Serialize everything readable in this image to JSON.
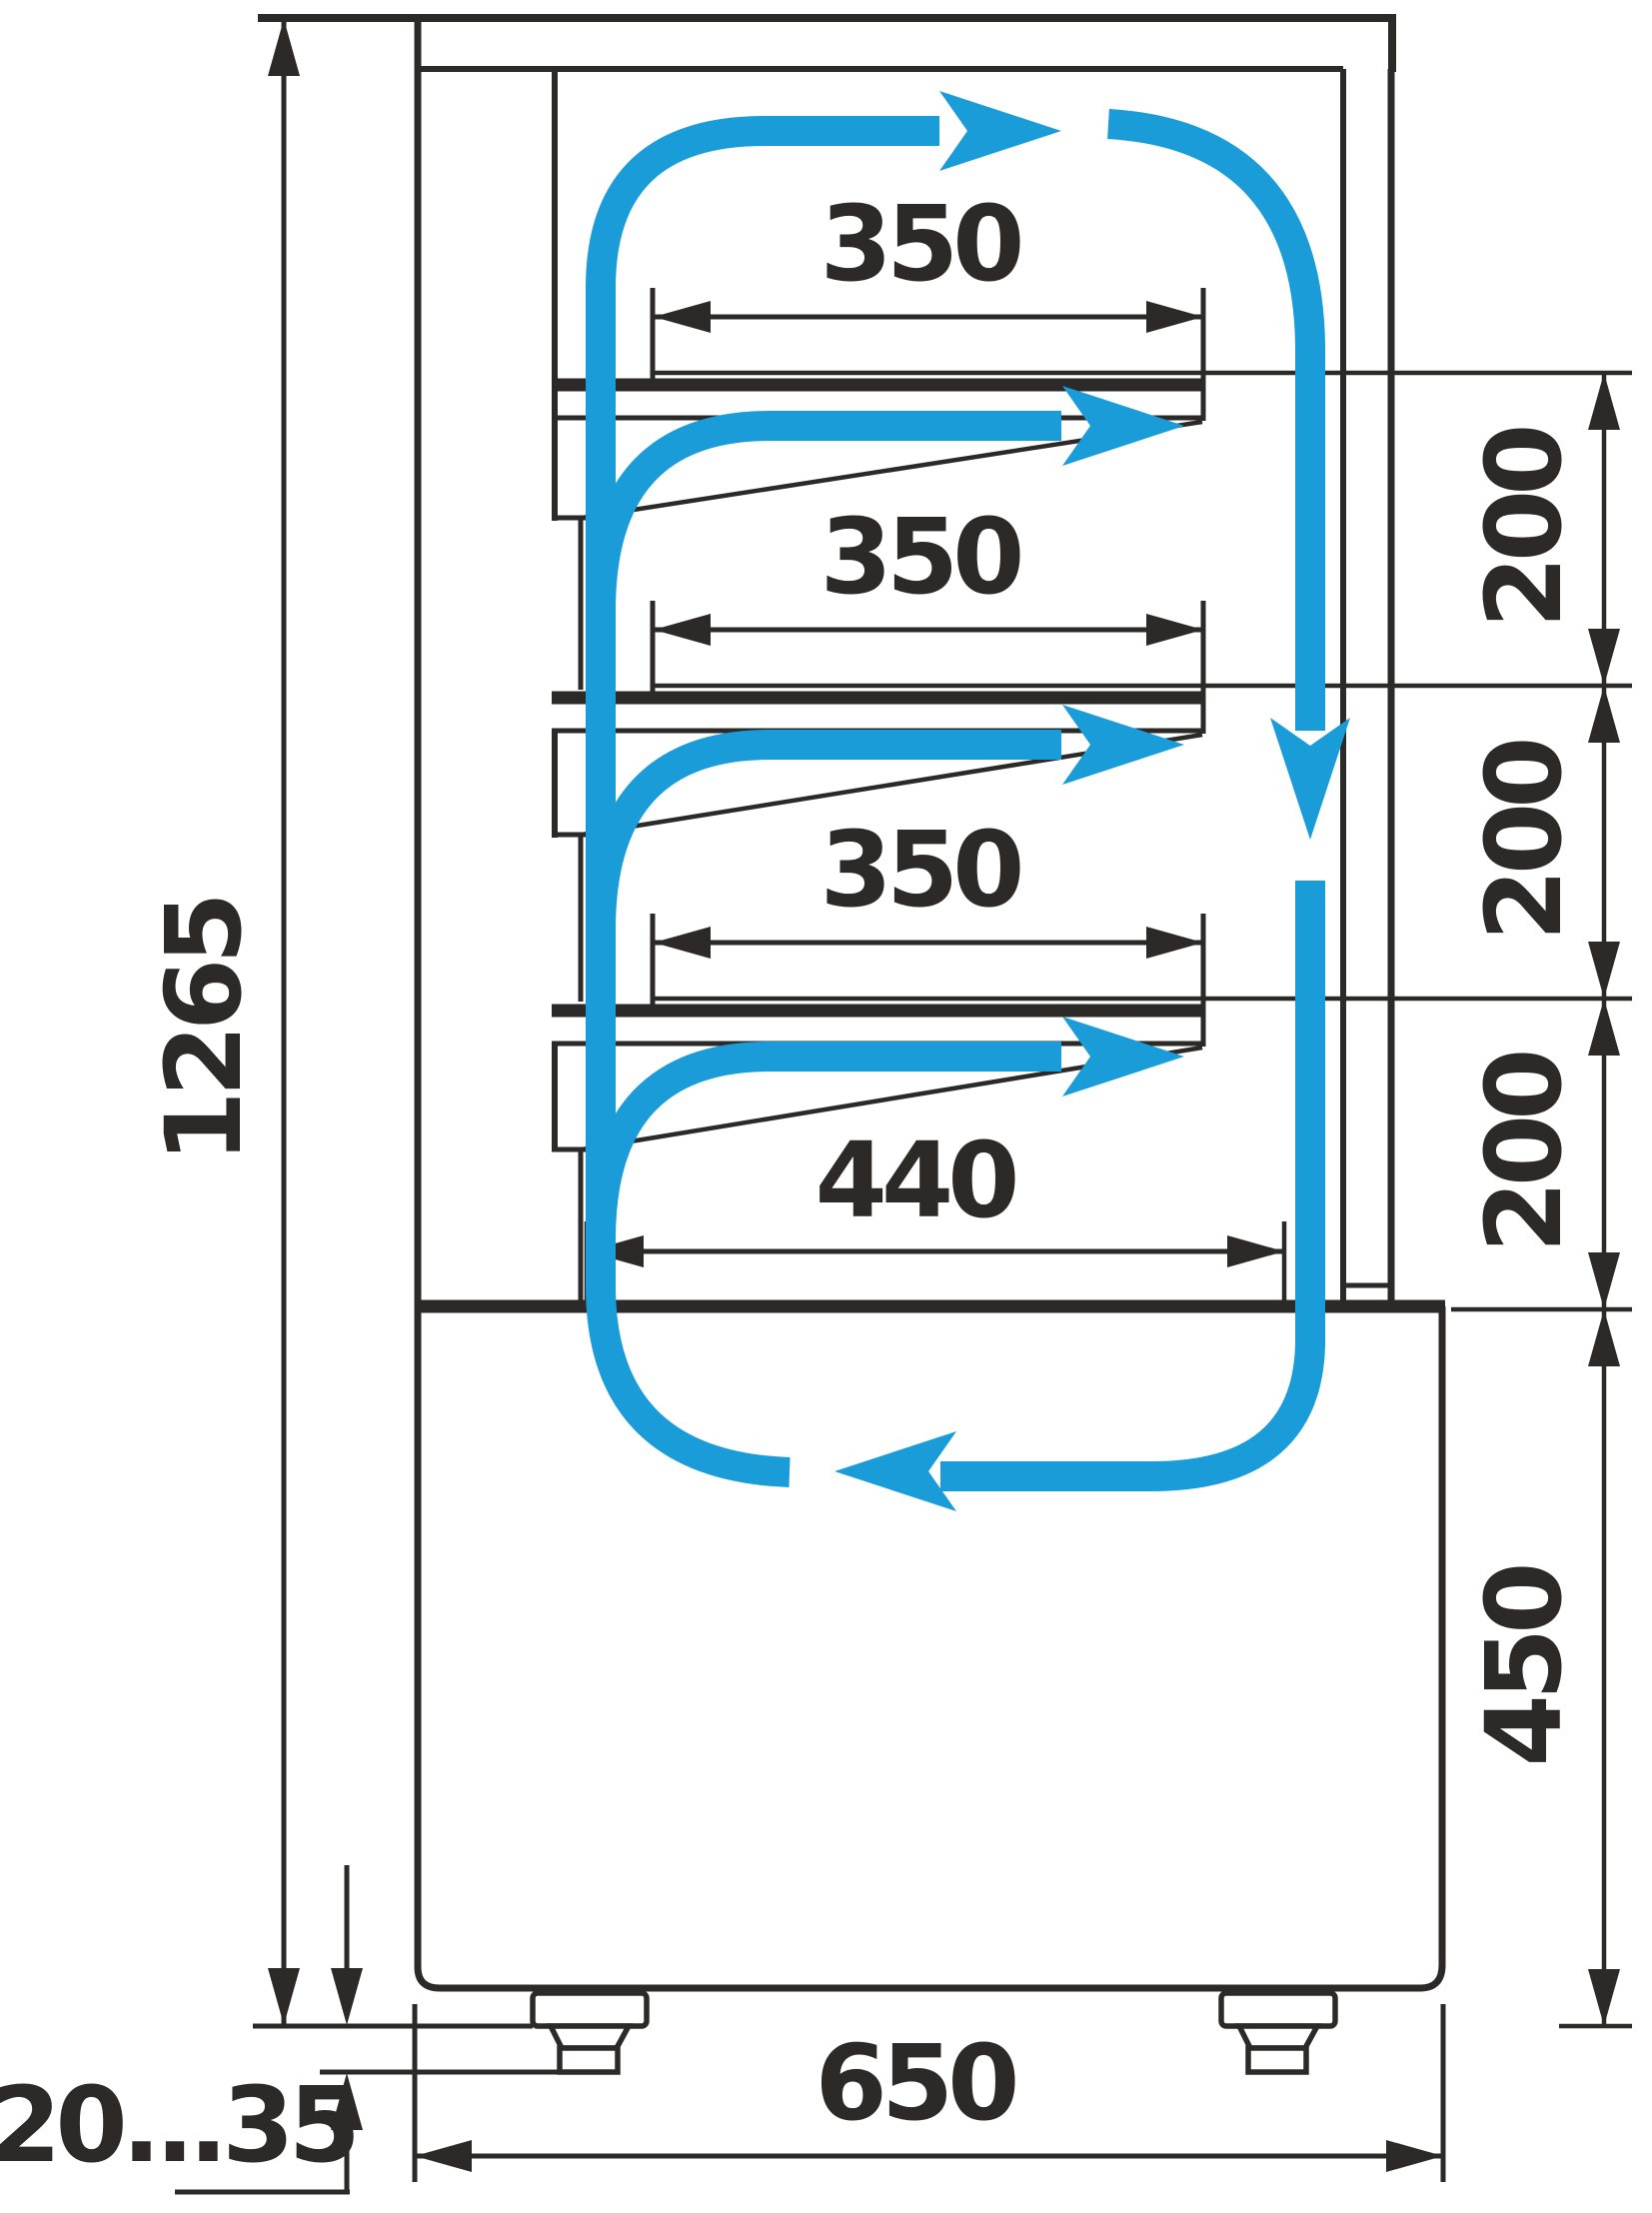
{
  "diagram": {
    "type": "refrigerated-display-case-side-section",
    "units": "mm",
    "colors": {
      "line": "#2b2a29",
      "airflow": "#1a9cd8",
      "background": "#ffffff"
    },
    "labels": {
      "overall_height": "1265",
      "shelf1_width": "350",
      "shelf2_width": "350",
      "shelf3_width": "350",
      "bottom_shelf_width": "440",
      "shelf_gap_1": "200",
      "shelf_gap_2": "200",
      "shelf_gap_3": "200",
      "base_height": "450",
      "depth": "650",
      "foot_adjust_range": "20...35"
    },
    "icons": {
      "airflow_arrows": "blue-air-circulation-arrows",
      "dimension_arrows": "black-dimension-arrowheads"
    }
  }
}
